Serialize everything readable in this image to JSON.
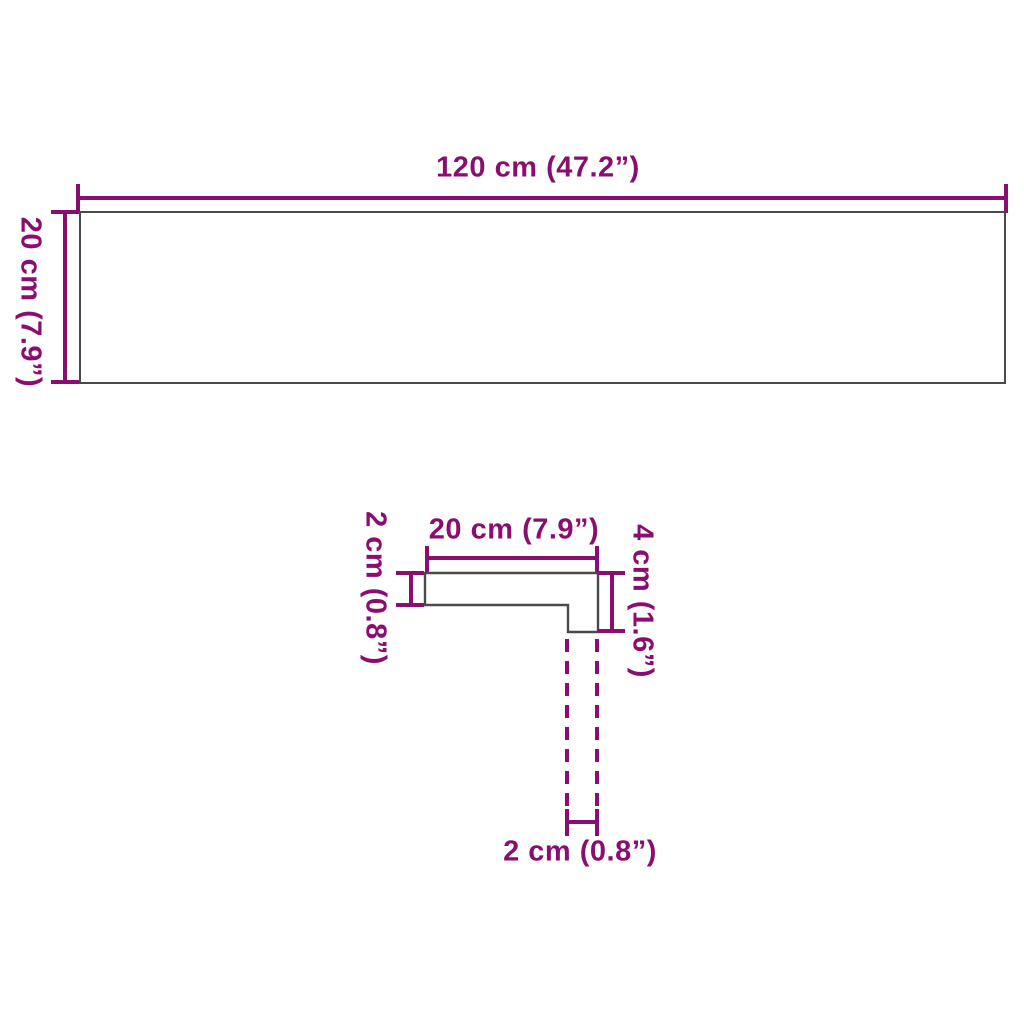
{
  "diagram": {
    "colors": {
      "dimension": "#8A0E6F",
      "outline": "#4A4A4A",
      "background": "#FFFFFF"
    },
    "top_view": {
      "width_label": "120 cm (47.2”)",
      "height_label": "20 cm (7.9”)"
    },
    "profile_view": {
      "width_label": "20 cm (7.9”)",
      "thickness_label": "2 cm (0.8”)",
      "height_label": "4 cm (1.6”)",
      "lip_width_label": "2 cm (0.8”)"
    }
  }
}
